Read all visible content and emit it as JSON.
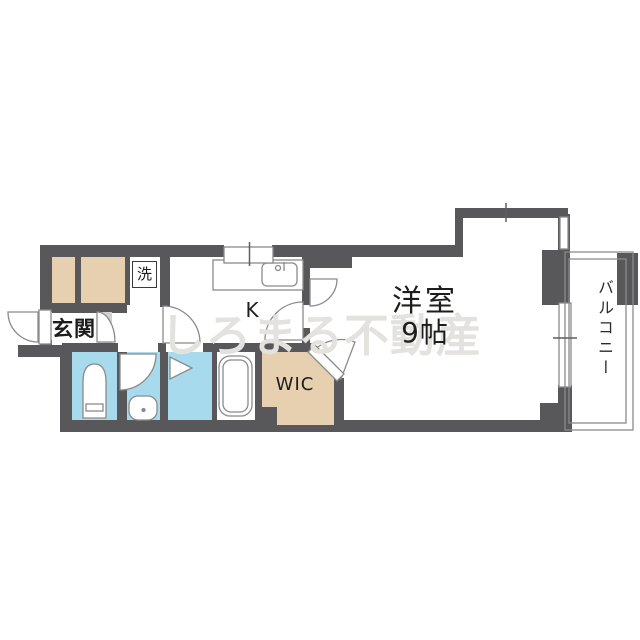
{
  "labels": {
    "entrance": "玄関",
    "washer": "洗",
    "kitchen": "K",
    "wic": "WIC",
    "main_room_name": "洋室",
    "main_room_size": "9帖",
    "balcony": "バルコニー"
  },
  "watermark": "しろまる不動産",
  "colors": {
    "wall": "#58585b",
    "closet": "#e6d0b0",
    "wet_area": "#a8daee",
    "step": "#d0d0cf",
    "line": "#8a8a8a",
    "tick": "#5f5f62",
    "fixture_fill": "#ffffff",
    "watermark": "#e3e2de",
    "text": "#1d1d1d"
  }
}
